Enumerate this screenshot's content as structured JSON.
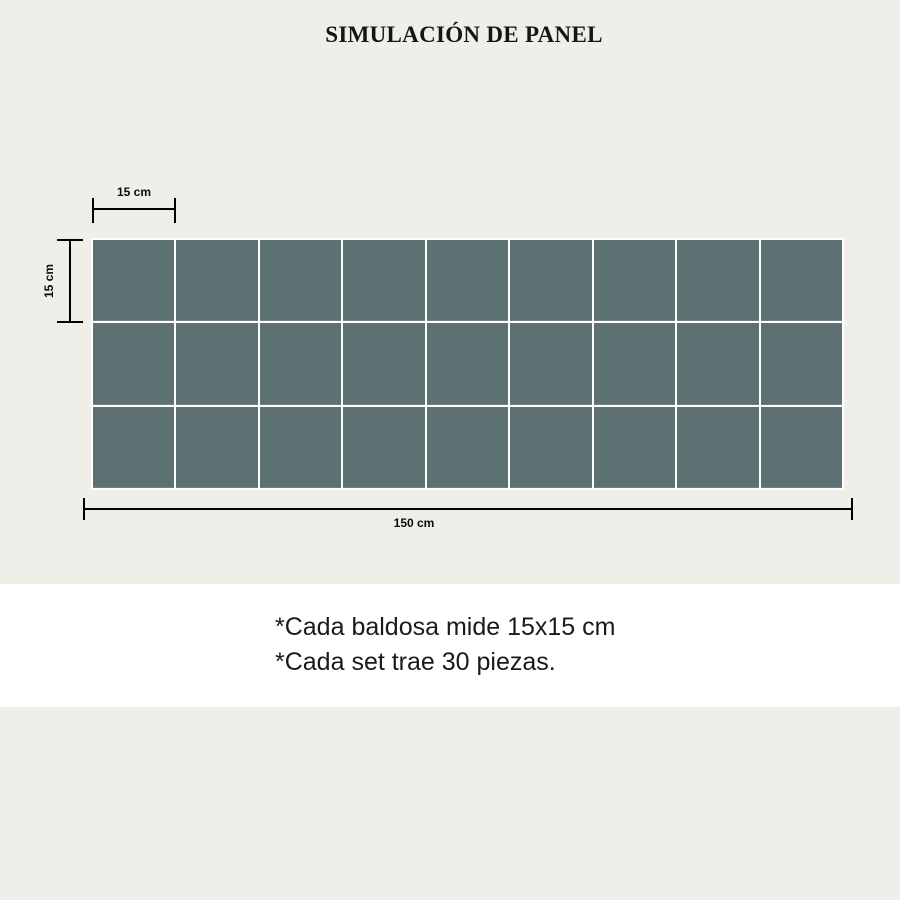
{
  "title": "SIMULACIÓN DE PANEL",
  "panel": {
    "rows": 3,
    "columns": 9,
    "tile_count": 27,
    "tile_color": "#5d7173"
  },
  "dimensions": {
    "tile_width_label": "15 cm",
    "tile_height_label": "15 cm",
    "panel_width_label": "150 cm"
  },
  "notes": {
    "line1": "*Cada baldosa mide 15x15 cm",
    "line2": "*Cada set trae 30 piezas."
  },
  "colors": {
    "background": "#efeee9",
    "band": "#ffffff",
    "tile": "#5d7173",
    "grout": "#ffffff",
    "line": "#000000",
    "text": "#1a1a1a"
  }
}
